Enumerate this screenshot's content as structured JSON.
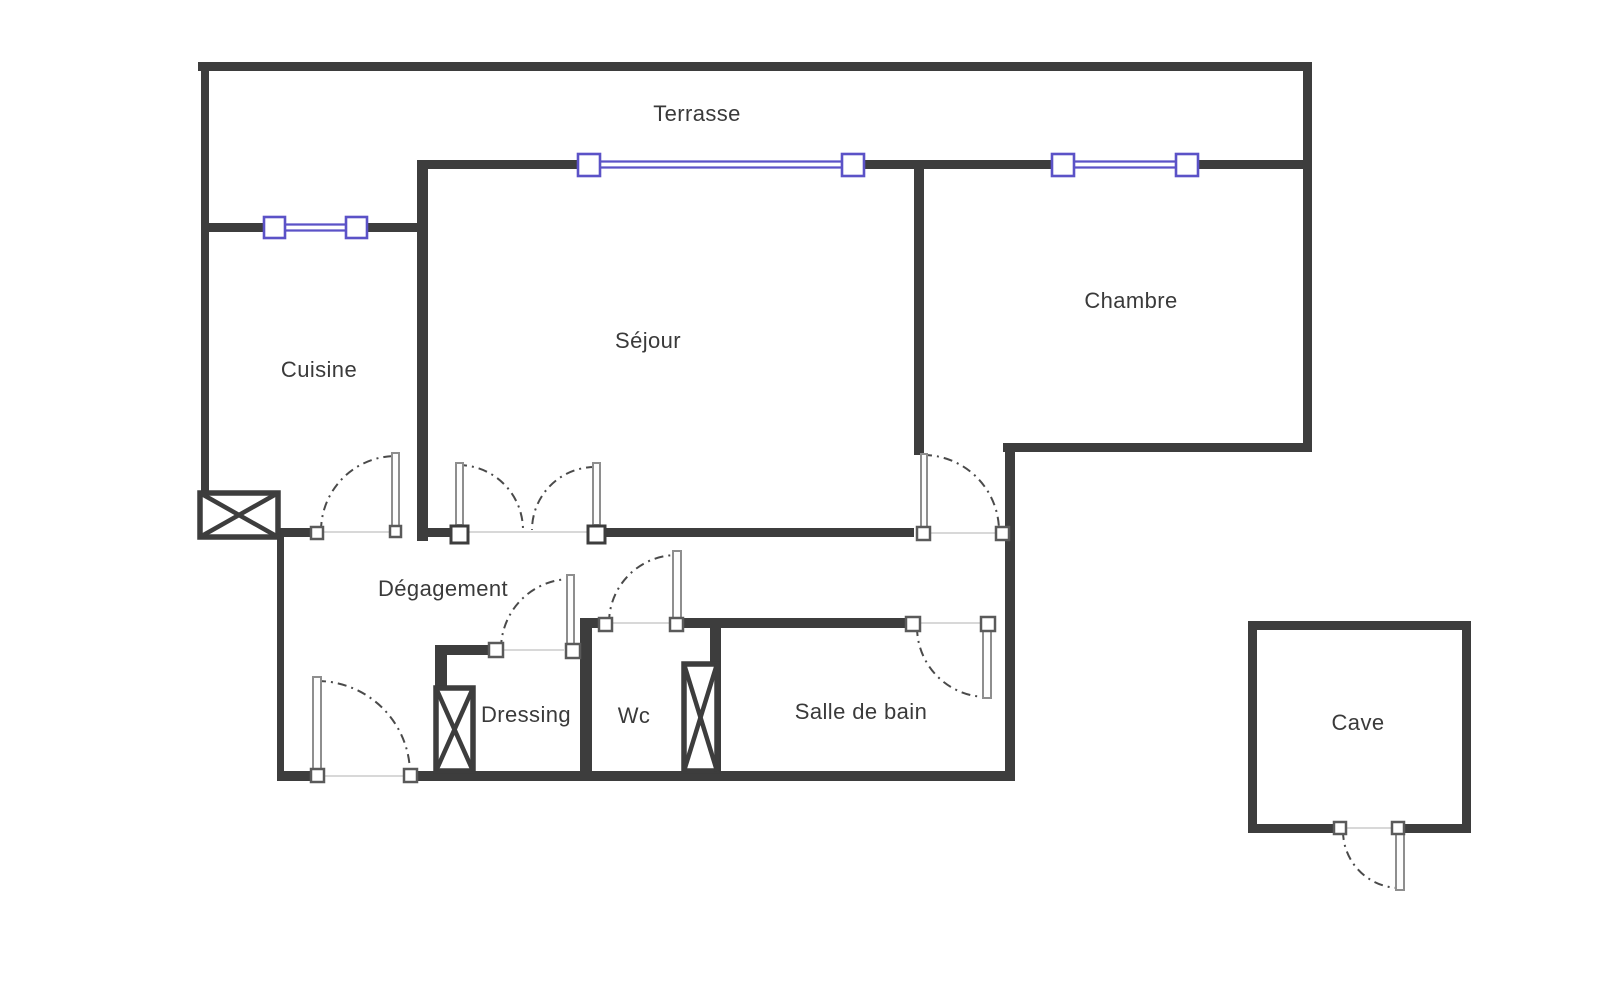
{
  "plan": {
    "rooms": {
      "terrasse": {
        "label": "Terrasse"
      },
      "cuisine": {
        "label": "Cuisine"
      },
      "sejour": {
        "label": "Séjour"
      },
      "chambre": {
        "label": "Chambre"
      },
      "degagement": {
        "label": "Dégagement"
      },
      "dressing": {
        "label": "Dressing"
      },
      "wc": {
        "label": "Wc"
      },
      "salle_de_bain": {
        "label": "Salle de bain"
      },
      "cave": {
        "label": "Cave"
      }
    },
    "symbols": {
      "window": "double blue line with square end posts",
      "door": "dash-dot quarter-circle swing arc with thin leaf",
      "duct": "crossed white box"
    },
    "colors": {
      "wall": "#3d3d3d",
      "window_accent": "#5b52c7",
      "door_arc": "#4a4a4a",
      "label_text": "#3a3a3a",
      "background": "#ffffff"
    }
  }
}
